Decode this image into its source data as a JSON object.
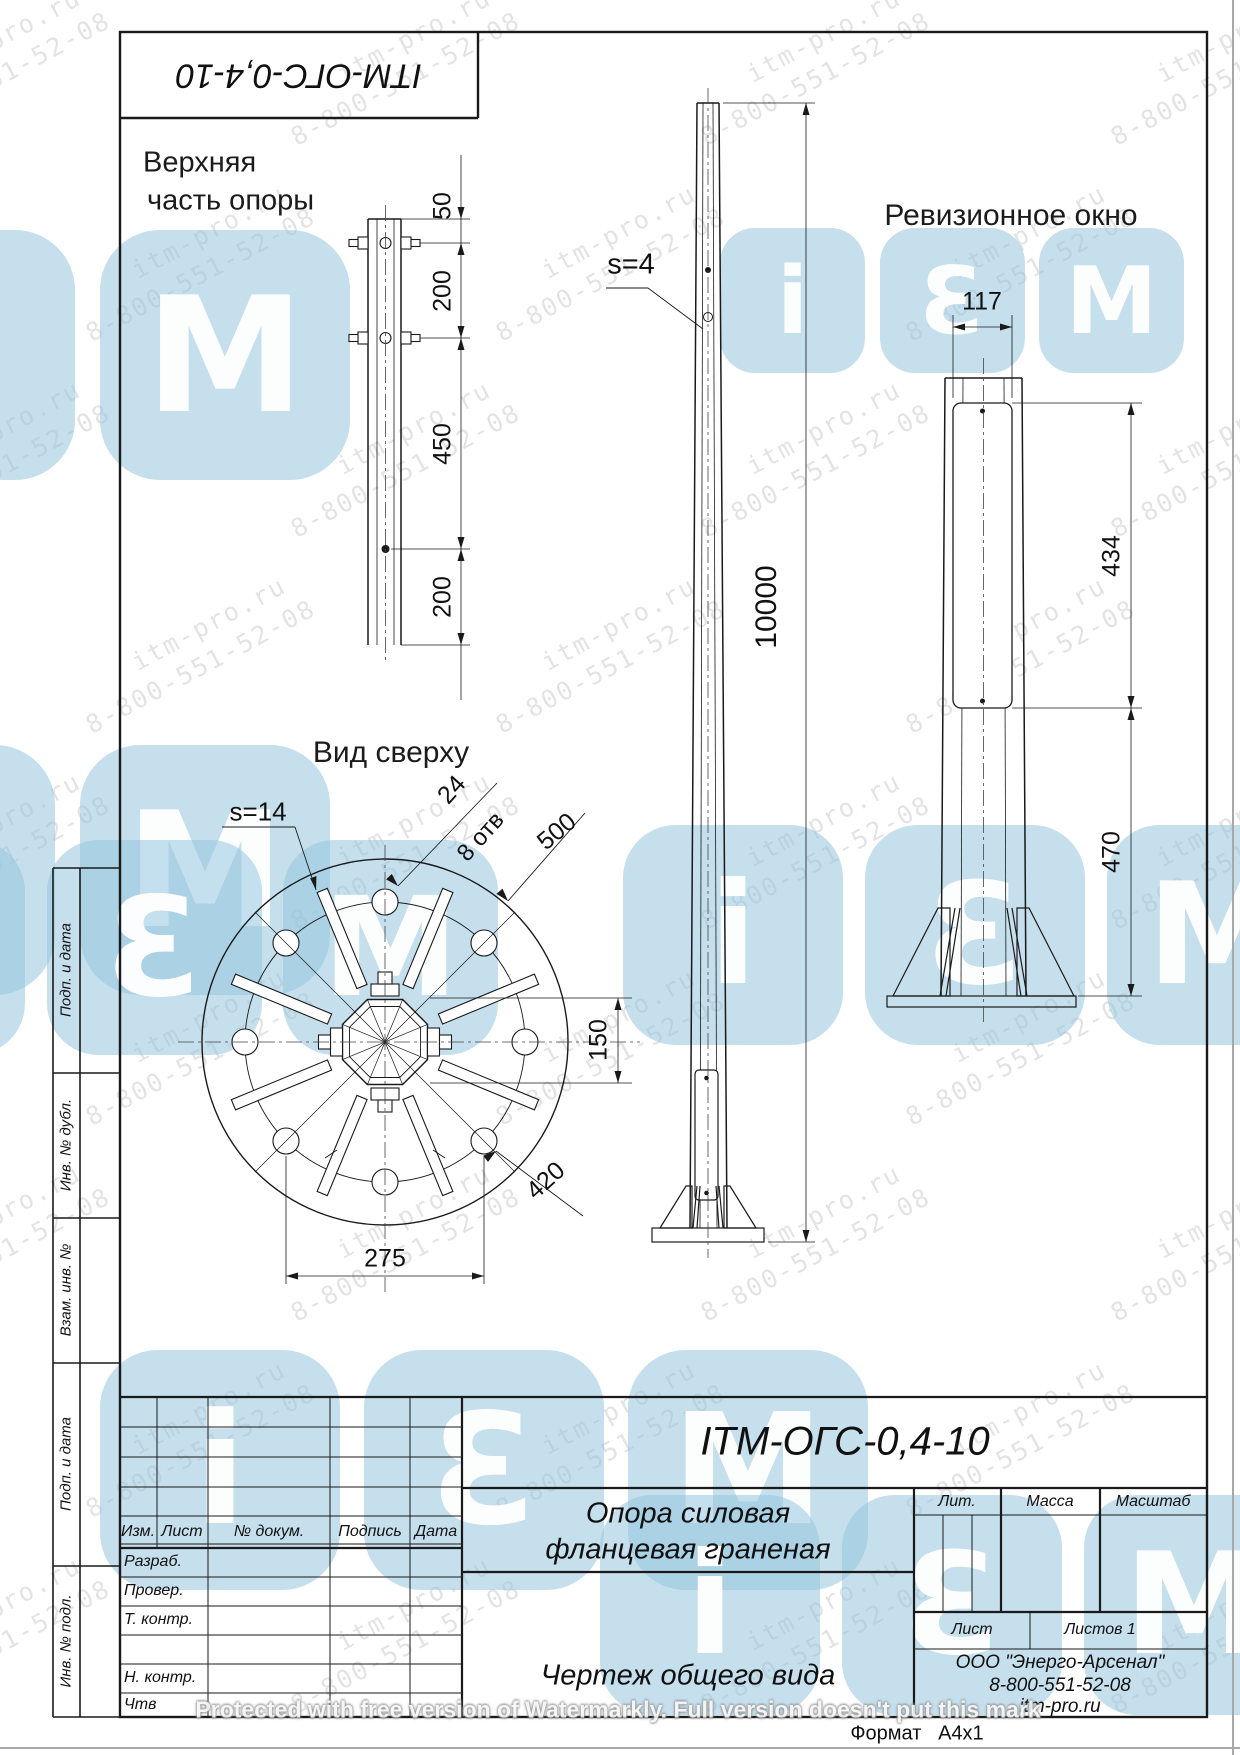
{
  "page": {
    "format_label": "Формат",
    "format_value": "A4x1",
    "protected_note": "Protected with free version of Watermarkly. Full version doesn't put this mark"
  },
  "stamp": {
    "designation": "ITM-ОГС-0,4-10"
  },
  "watermark": {
    "url": "itm-pro.ru",
    "phone": "8-800-551-52-08",
    "logo": [
      "i",
      "Ɛ",
      "M"
    ]
  },
  "views": {
    "upper": {
      "title1": "Верхняя",
      "title2": "часть опоры",
      "d1": "50",
      "d2": "200",
      "d3": "450",
      "d4": "200"
    },
    "front": {
      "wall": "s=4",
      "height": "10000"
    },
    "revision": {
      "title": "Ревизионное окно",
      "width": "117",
      "win_h": "434",
      "offset": "470"
    },
    "plan": {
      "title": "Вид сверху",
      "wall": "s=14",
      "hole": "24",
      "holes": "8 отв",
      "outer": "500",
      "flats": "150",
      "bolt_circle": "420",
      "spacing": "275"
    }
  },
  "sidebar": {
    "items": [
      {
        "label": "Подп. и дата"
      },
      {
        "label": "Инв. № дубл."
      },
      {
        "label": "Взам. инв. №"
      },
      {
        "label": "Подп. и дата"
      },
      {
        "label": "Инв. № подл."
      }
    ]
  },
  "title_block": {
    "designation": "ITM-ОГС-0,4-10",
    "name1": "Опора силовая",
    "name2": "фланцевая граненая",
    "doc_type": "Чертеж общего вида",
    "company1": "ООО \"Энерго-Арсенал\"",
    "company2": "8-800-551-52-08",
    "company3": "itm-pro.ru",
    "lit": "Лит.",
    "mass": "Масса",
    "scale": "Масштаб",
    "sheet": "Лист",
    "sheets": "Листов 1",
    "rev_headers": {
      "izm": "Изм.",
      "list": "Лист",
      "doc": "№ докум.",
      "sign": "Подпись",
      "date": "Дата"
    },
    "staff": [
      {
        "label": "Разраб."
      },
      {
        "label": "Провер."
      },
      {
        "label": "Т. контр."
      },
      {
        "label": ""
      },
      {
        "label": "Н. контр."
      },
      {
        "label": "Чтв"
      }
    ]
  }
}
